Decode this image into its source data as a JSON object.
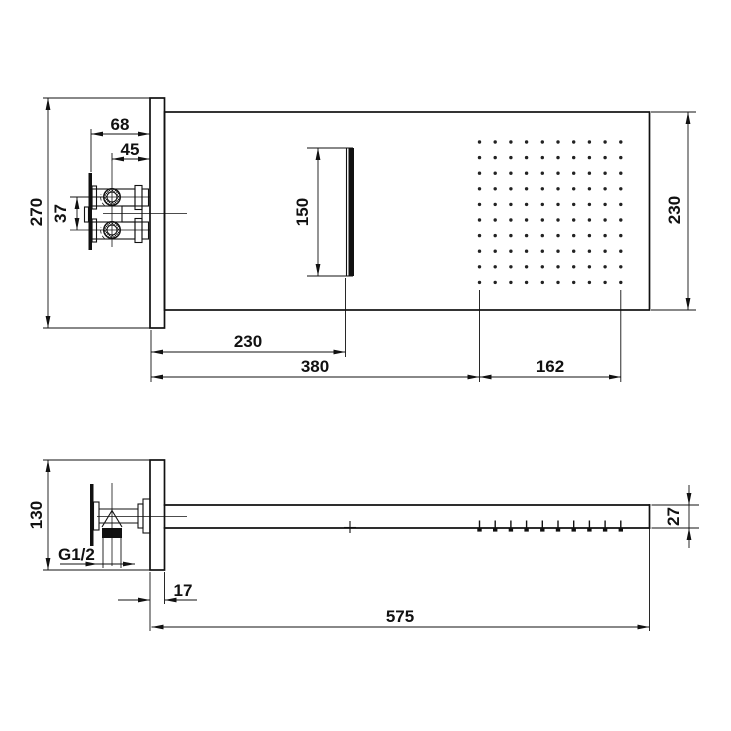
{
  "colors": {
    "line": "#111111",
    "background": "#ffffff"
  },
  "top_view": {
    "dims": {
      "plate_height": "270",
      "valve_body_depth": "68",
      "valve_center_depth": "45",
      "valve_spacing": "37",
      "waterfall_slot": "150",
      "slot_offset": "230",
      "spray_start_offset": "380",
      "spray_field_width": "162",
      "panel_depth": "230"
    }
  },
  "side_view": {
    "dims": {
      "plate_height": "130",
      "inlet_thread": "G1/2",
      "plate_thickness": "17",
      "panel_length": "575",
      "panel_thickness": "27"
    }
  },
  "nozzle_grid": {
    "rows": 10,
    "cols": 10,
    "x0": 479.5,
    "y0": 142,
    "step_x": 15.7,
    "step_y": 15.6
  }
}
